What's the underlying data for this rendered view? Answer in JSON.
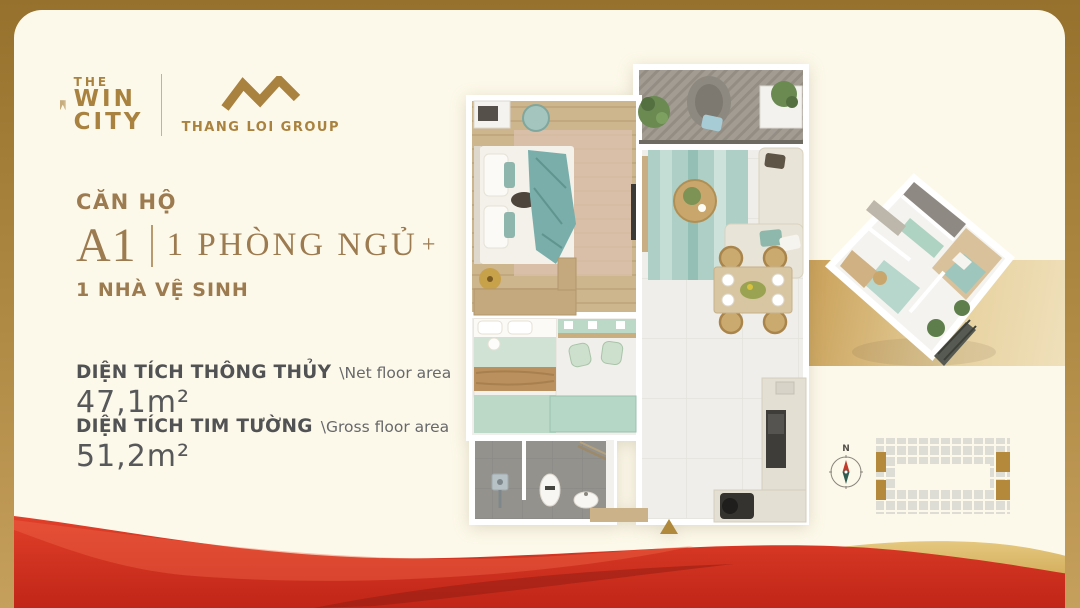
{
  "brand": {
    "win_city_logo": {
      "line1": "THE",
      "line2": "WIN",
      "line3": "CITY"
    },
    "thang_loi_logo": {
      "name": "THANG LOI GROUP"
    }
  },
  "unit": {
    "category_label": "CĂN HỘ",
    "code": "A1",
    "bedroom_label": "1 PHÒNG NGỦ",
    "bedroom_plus": "+",
    "bathroom_label": "1 NHÀ VỆ SINH"
  },
  "areas": {
    "net": {
      "label_vi": "DIỆN TÍCH THÔNG THỦY",
      "label_en": "\\Net floor area",
      "value": "47,1m²"
    },
    "gross": {
      "label_vi": "DIỆN TÍCH TIM TƯỜNG",
      "label_en": "\\Gross floor area",
      "value": "51,2m²"
    }
  },
  "site_plan": {
    "compass_north_label": "N"
  },
  "colors": {
    "brand_gold": "#a9823f",
    "title_bronze": "#9d7b50",
    "text_dark": "#515254",
    "mint": "#bcd9c8",
    "teal": "#8fb8ac",
    "ribbon_red": "#d03222",
    "frame_gold": "#a5803c"
  }
}
